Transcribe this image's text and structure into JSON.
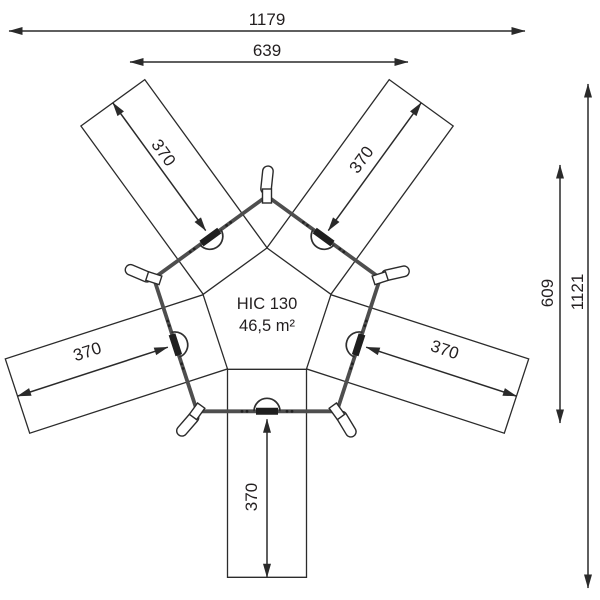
{
  "diagram": {
    "product": {
      "model": "HIC 130",
      "area": "46,5 m²"
    },
    "dimensions": {
      "overall_width": "1179",
      "top_platform_width": "639",
      "right_inner_height": "609",
      "overall_height": "1121",
      "arm_top_left": "370",
      "arm_top_right": "370",
      "arm_left": "370",
      "arm_right": "370",
      "arm_bottom": "370"
    },
    "colors": {
      "line": "#2a2a2a",
      "frame": "#4e4e4e",
      "text": "#231f20",
      "background": "#ffffff"
    }
  }
}
